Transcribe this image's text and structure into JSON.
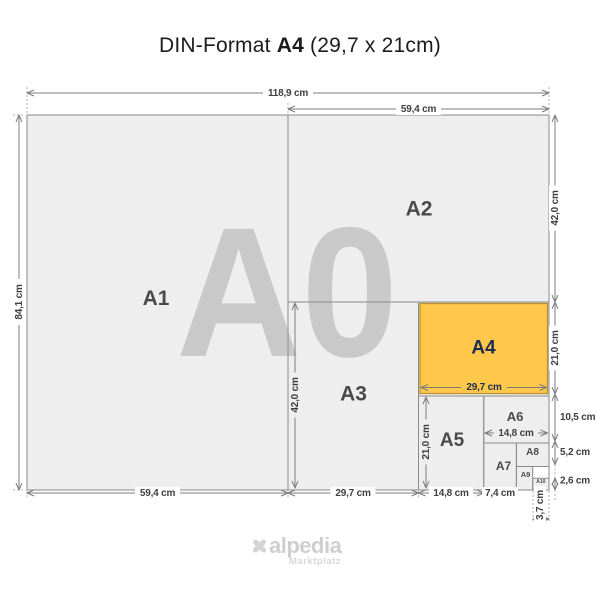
{
  "title": {
    "prefix": "DIN-Format",
    "bold": "A4",
    "suffix": "(29,7 x 21cm)"
  },
  "watermark": "A0",
  "sheets": {
    "a1": "A1",
    "a2": "A2",
    "a3": "A3",
    "a4": "A4",
    "a5": "A5",
    "a6": "A6",
    "a7": "A7",
    "a8": "A8",
    "a9": "A9",
    "a10": "A10"
  },
  "dimensions": {
    "total_width": "118,9 cm",
    "total_height": "84,1 cm",
    "a2_width": "59,4 cm",
    "a2_height": "42,0 cm",
    "a1_width": "59,4 cm",
    "a3_width": "29,7 cm",
    "a3_height": "42,0 cm",
    "a4_width": "29,7 cm",
    "a4_height": "21,0 cm",
    "a5_width": "14,8 cm",
    "a5_height": "21,0 cm",
    "a6_width": "14,8 cm",
    "a6_height": "10,5 cm",
    "a7_width": "7,4 cm",
    "a8_height": "5,2 cm",
    "a9_width": "3,7 cm",
    "a10_height": "2,6 cm"
  },
  "footer": {
    "brand": "alpedia",
    "tagline": "Marktplatz"
  },
  "colors": {
    "a4_fill": "#FFC84A",
    "a4_border": "#B9902F",
    "a4_text": "#1E2D4F",
    "sheet_fill": "#EEEEEE",
    "sheet_border": "#8B8B8B",
    "watermark": "#C9C9C9",
    "dim_line": "#7D7D7D",
    "dim_text": "#3F3F3F",
    "logo": "#D2D2D2"
  }
}
